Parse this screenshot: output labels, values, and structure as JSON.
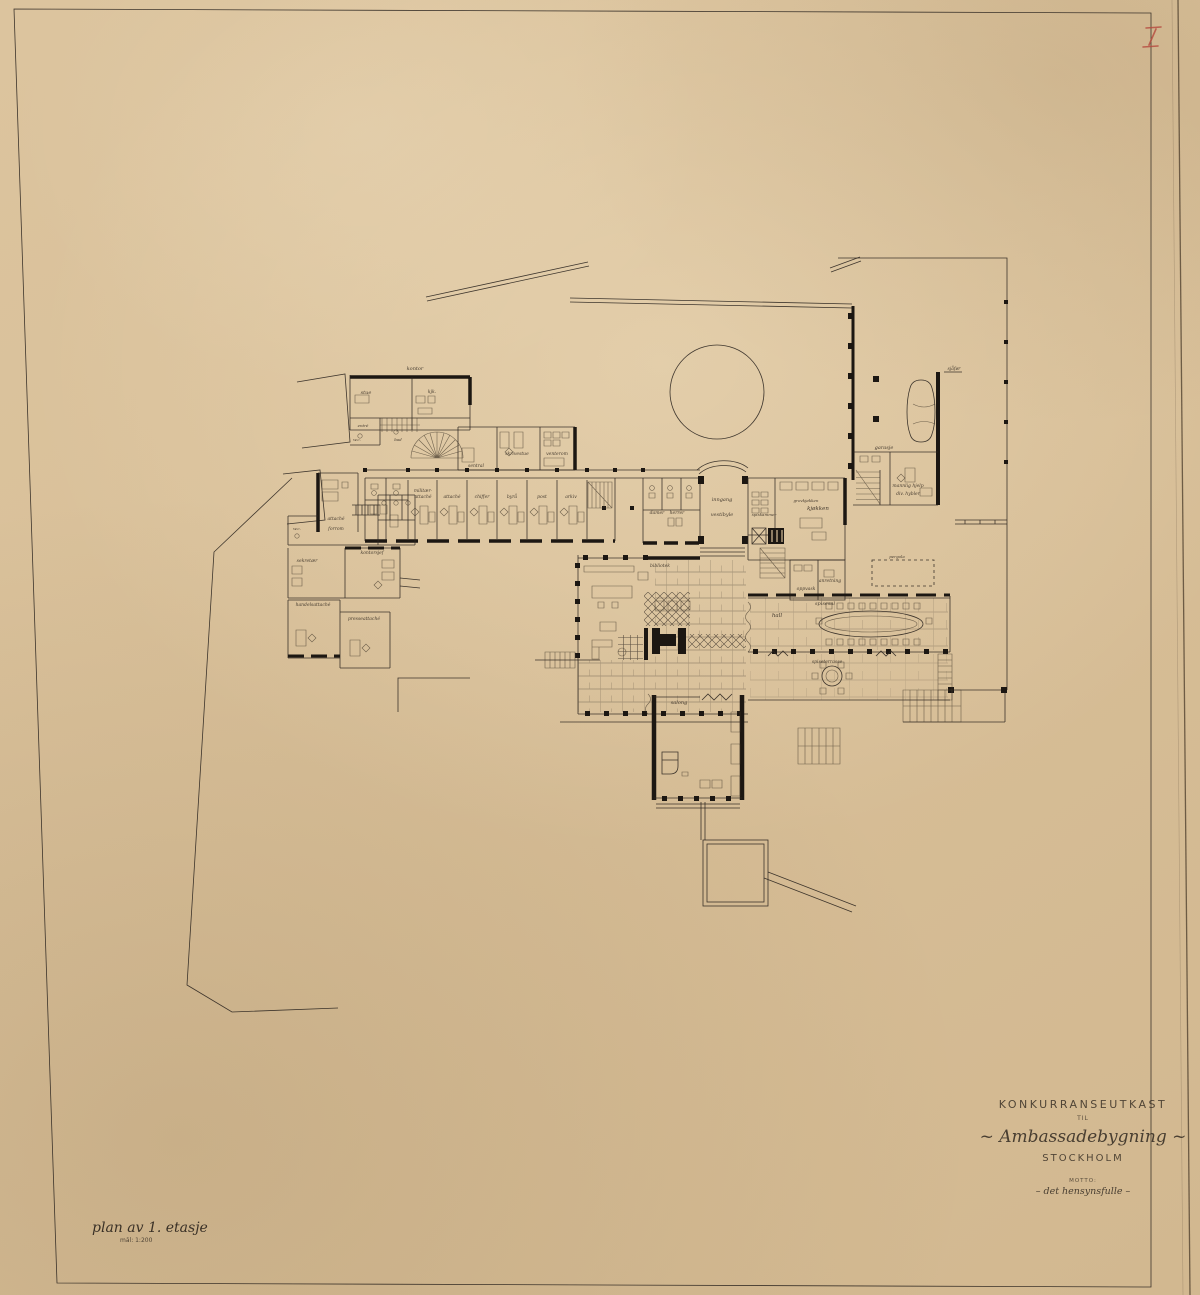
{
  "sheet": {
    "number": "I",
    "caption": {
      "line1": "plan av 1. etasje",
      "line2": "mål: 1:200"
    },
    "title_block": {
      "line1": "KONKURRANSEUTKAST",
      "line2": "TIL",
      "line3": "~ Ambassadebygning ~",
      "line4": "STOCKHOLM",
      "line5": "MOTTO:",
      "line6": "– det hensynsfulle –"
    },
    "colors": {
      "paper": "#d9c19a",
      "ink": "#2c2620",
      "red_pencil": "#b5493d"
    }
  },
  "plan": {
    "labels": [
      {
        "t": "kontor",
        "x": 415,
        "y": 370,
        "s": 5
      },
      {
        "t": "stue",
        "x": 366,
        "y": 394,
        "s": 5
      },
      {
        "t": "kjk.",
        "x": 432,
        "y": 393,
        "s": 4.5
      },
      {
        "t": "entré",
        "x": 363,
        "y": 427,
        "s": 4
      },
      {
        "t": "w.c.",
        "x": 357,
        "y": 441,
        "s": 4
      },
      {
        "t": "bad",
        "x": 398,
        "y": 441,
        "s": 4
      },
      {
        "t": "sentral",
        "x": 476,
        "y": 467,
        "s": 4.5
      },
      {
        "t": "skrivestue",
        "x": 517,
        "y": 455,
        "s": 4.5
      },
      {
        "t": "venterom",
        "x": 557,
        "y": 455,
        "s": 4.5
      },
      {
        "t": "militær-",
        "x": 423,
        "y": 492,
        "s": 4.5
      },
      {
        "t": "attaché",
        "x": 423,
        "y": 498,
        "s": 4.5
      },
      {
        "t": "attaché",
        "x": 452,
        "y": 498,
        "s": 4.5
      },
      {
        "t": "chiffer",
        "x": 482,
        "y": 498,
        "s": 4.5
      },
      {
        "t": "byrå",
        "x": 512,
        "y": 498,
        "s": 4.5
      },
      {
        "t": "post",
        "x": 542,
        "y": 498,
        "s": 4.5
      },
      {
        "t": "arkiv",
        "x": 571,
        "y": 498,
        "s": 4.5
      },
      {
        "t": "damer",
        "x": 657,
        "y": 514,
        "s": 4.5
      },
      {
        "t": "herrer",
        "x": 677,
        "y": 514,
        "s": 4.5
      },
      {
        "t": "inngang",
        "x": 722,
        "y": 501,
        "s": 5
      },
      {
        "t": "vestibyle",
        "x": 722,
        "y": 516,
        "s": 5
      },
      {
        "t": "spiskammer",
        "x": 764,
        "y": 516,
        "s": 4
      },
      {
        "t": "grovkjøkken",
        "x": 806,
        "y": 502,
        "s": 4
      },
      {
        "t": "kjøkken",
        "x": 818,
        "y": 510,
        "s": 5.5
      },
      {
        "t": "anretning",
        "x": 830,
        "y": 582,
        "s": 4.5
      },
      {
        "t": "oppvask",
        "x": 806,
        "y": 590,
        "s": 4.5
      },
      {
        "t": "sjåfør",
        "x": 954,
        "y": 370,
        "s": 4.5
      },
      {
        "t": "garasje",
        "x": 884,
        "y": 449,
        "s": 5
      },
      {
        "t": "mannlig hjelp",
        "x": 908,
        "y": 487,
        "s": 4.5
      },
      {
        "t": "div. hybler",
        "x": 908,
        "y": 495,
        "s": 4.5
      },
      {
        "t": "pergola",
        "x": 897,
        "y": 558,
        "s": 4
      },
      {
        "t": "bibliotek",
        "x": 660,
        "y": 567,
        "s": 4.5
      },
      {
        "t": "hall",
        "x": 777,
        "y": 617,
        "s": 5.5
      },
      {
        "t": "spisesal",
        "x": 825,
        "y": 605,
        "s": 5
      },
      {
        "t": "spiseterrasse",
        "x": 827,
        "y": 663,
        "s": 4.5
      },
      {
        "t": "salong",
        "x": 679,
        "y": 704,
        "s": 5
      },
      {
        "t": "attaché",
        "x": 336,
        "y": 520,
        "s": 4.5
      },
      {
        "t": "forrom",
        "x": 336,
        "y": 530,
        "s": 4.5
      },
      {
        "t": "w.c.",
        "x": 297,
        "y": 530,
        "s": 4
      },
      {
        "t": "kontorsjef",
        "x": 372,
        "y": 554,
        "s": 4.5
      },
      {
        "t": "sekretær",
        "x": 307,
        "y": 562,
        "s": 4.5
      },
      {
        "t": "handelsattaché",
        "x": 313,
        "y": 606,
        "s": 4.5
      },
      {
        "t": "presseattaché",
        "x": 364,
        "y": 620,
        "s": 4.5
      }
    ]
  }
}
